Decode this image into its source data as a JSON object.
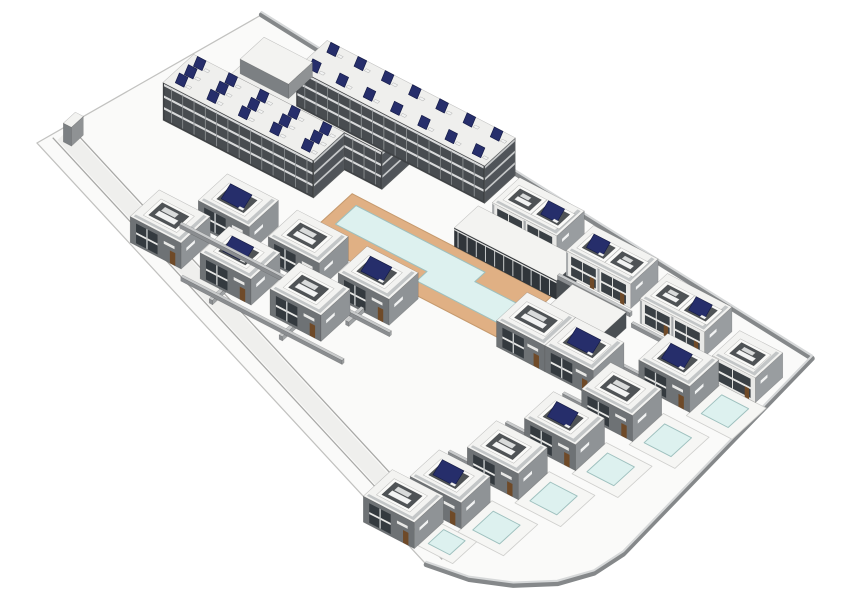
{
  "meta": {
    "view": "axonometric-3d-site-model",
    "subject": "residential-complex-with-apartments-townhouses-villas-and-pools"
  },
  "palette": {
    "bg": "#ffffff",
    "parcel": "#fafaf9",
    "parcelEdge": "#c2c2c0",
    "roadBand": "#efefed",
    "roadEdge": "#a8a8a6",
    "perimWall": "#85888a",
    "perimTop": "#d6d8d9",
    "roof": "#f3f3f1",
    "roofSlab": "#efefed",
    "parapet": "#c3c6c7",
    "faceEdge": "rgba(50,50,50,0.28)",
    "slabWallS": "#3f4245",
    "slabWallE": "#565a5d",
    "slabGlass": "#484c50",
    "slabStripe": "#d9dadb",
    "slabMullion": "#8e9294",
    "villaWallS": "#6e7275",
    "villaWallE": "#8f9396",
    "villaGlass": "#343a3f",
    "villaFloor": "#e8e8e6",
    "villaMullion": "#c7cacb",
    "door": "#6f4a28",
    "thWallS": "#e9e9e7",
    "thWallE": "#999da0",
    "thGlass": "#3a4045",
    "thParty": "#a6a9ab",
    "clubWallE": "#4a4f53",
    "clubGlass": "#30353a",
    "clubMullion": "#cfd1d2",
    "pentWallS": "#7c8083",
    "pentWallE": "#8f9294",
    "wallS": "#8a8d90",
    "wallE": "#9fa2a4",
    "wallTop": "#c9cbcc",
    "panel": "#262e6b",
    "panelEdge": "#141a45",
    "equip": "#f2f3f3",
    "equip2": "#d9dbdb",
    "courtShaft": "#4f5356",
    "courtRim": "#fafaf8",
    "poolWater": "#ddf1ef",
    "poolEdge": "#9ec0be",
    "deckTan": "#e0b084",
    "deckEdge": "#c59a6e",
    "terrace": "#f6f6f4",
    "terraceEdge": "#cfcfcd"
  },
  "projection": {
    "e": [
      2.55,
      1.32
    ],
    "n": [
      1.62,
      -1.48
    ],
    "zs": 2.75,
    "margin": 14
  },
  "scene": {
    "parcel": [
      [
        -30,
        0
      ],
      [
        -10,
        100
      ],
      [
        210,
        76
      ],
      [
        216,
        -44
      ],
      [
        214,
        -58
      ],
      [
        208,
        -70
      ],
      [
        198,
        -80
      ],
      [
        186,
        -87
      ],
      [
        172,
        -90
      ]
    ],
    "perimeterWall": [
      [
        -10,
        100
      ],
      [
        210,
        76
      ],
      [
        216,
        -44
      ],
      [
        214,
        -58
      ],
      [
        208,
        -70
      ],
      [
        198,
        -80
      ],
      [
        186,
        -87
      ],
      [
        172,
        -90
      ]
    ],
    "road": {
      "band": [
        [
          176.1,
          -80.9
        ],
        [
          -25.9,
          9.1
        ]
      ],
      "edges": [
        [
          [
            174.4,
            -84.5
          ],
          [
            -27.6,
            5.5
          ]
        ],
        [
          [
            177.7,
            -77.2
          ],
          [
            -24.3,
            12.8
          ]
        ]
      ]
    },
    "deck": {
      "x": 58,
      "y": 18,
      "w": 74,
      "d": 28
    },
    "mainPool": [
      [
        62,
        30
      ],
      [
        96,
        30
      ],
      [
        96,
        24
      ],
      [
        126,
        24
      ],
      [
        126,
        36
      ],
      [
        110,
        36
      ],
      [
        110,
        42
      ],
      [
        62,
        42
      ]
    ],
    "terraces": [
      {
        "id": "pool-terrace-1",
        "x": 195,
        "y": 26,
        "w": 17,
        "d": 20
      },
      {
        "id": "pool-terrace-2",
        "x": 189,
        "y": 2,
        "w": 17,
        "d": 20
      },
      {
        "id": "pool-terrace-3",
        "x": 183,
        "y": -22,
        "w": 17,
        "d": 20
      },
      {
        "id": "pool-terrace-4",
        "x": 177,
        "y": -46,
        "w": 17,
        "d": 20
      },
      {
        "id": "pool-terrace-5",
        "x": 171,
        "y": -70,
        "w": 17,
        "d": 20
      },
      {
        "id": "pool-terrace-6",
        "x": 165,
        "y": -84,
        "w": 13,
        "d": 14
      }
    ],
    "pools": [
      {
        "id": "villa-pool-1",
        "x": 198,
        "y": 30,
        "w": 10,
        "d": 12
      },
      {
        "id": "villa-pool-2",
        "x": 192,
        "y": 6,
        "w": 10,
        "d": 12
      },
      {
        "id": "villa-pool-3",
        "x": 186,
        "y": -18,
        "w": 10,
        "d": 12
      },
      {
        "id": "villa-pool-4",
        "x": 180,
        "y": -42,
        "w": 10,
        "d": 12
      },
      {
        "id": "villa-pool-5",
        "x": 174,
        "y": -66,
        "w": 10,
        "d": 12
      },
      {
        "id": "villa-pool-6",
        "x": 167,
        "y": -81,
        "w": 8,
        "d": 9
      }
    ],
    "boxes": [
      {
        "id": "apartment-slab-west",
        "type": "slab",
        "x": -6,
        "y": 36,
        "w": 56,
        "d": 18,
        "h": 13,
        "panels": {
          "rows": 3,
          "cols": 5
        }
      },
      {
        "id": "apartment-slab-mid",
        "type": "slab",
        "x": 8,
        "y": 54,
        "w": 56,
        "d": 18,
        "h": 13
      },
      {
        "id": "apartment-penthouse",
        "type": "penthouse",
        "x": 10,
        "y": 56,
        "w": 18,
        "d": 14,
        "h": 18,
        "z0": 13
      },
      {
        "id": "apartment-slab-north",
        "type": "slab",
        "x": 22,
        "y": 70,
        "w": 70,
        "d": 18,
        "h": 13,
        "panels": {
          "rows": 2,
          "cols": 7
        }
      },
      {
        "id": "townhouse-duplex-1",
        "type": "townhouse",
        "x": 100,
        "y": 62,
        "w": 24,
        "d": 16,
        "h": 8.5,
        "courts": [
          {
            "x": 3,
            "y": 4.5,
            "w": 8,
            "d": 7,
            "panel": false
          },
          {
            "x": 13.5,
            "y": 4.5,
            "w": 8,
            "d": 7,
            "panel": true
          }
        ]
      },
      {
        "id": "townhouse-duplex-2",
        "type": "townhouse",
        "x": 130,
        "y": 58,
        "w": 24,
        "d": 16,
        "h": 8.5,
        "courts": [
          {
            "x": 3,
            "y": 4.5,
            "w": 8,
            "d": 7,
            "panel": true
          },
          {
            "x": 13.5,
            "y": 4.5,
            "w": 8,
            "d": 7,
            "panel": false
          }
        ]
      },
      {
        "id": "townhouse-duplex-3",
        "type": "townhouse",
        "x": 160,
        "y": 54,
        "w": 24,
        "d": 16,
        "h": 8.5,
        "courts": [
          {
            "x": 3,
            "y": 4.5,
            "w": 8,
            "d": 7,
            "panel": false
          },
          {
            "x": 13.5,
            "y": 4.5,
            "w": 8,
            "d": 7,
            "panel": true
          }
        ]
      },
      {
        "id": "townhouse-single-1",
        "type": "townhouse",
        "x": 192,
        "y": 46,
        "w": 16,
        "d": 16,
        "h": 8.5,
        "courts": [
          {
            "x": 3.5,
            "y": 4.5,
            "w": 9,
            "d": 7,
            "panel": false
          }
        ]
      },
      {
        "id": "clubhouse",
        "type": "clubhouse",
        "x": 96,
        "y": 46,
        "w": 38,
        "d": 14,
        "h": 6.5
      },
      {
        "id": "pool-house",
        "type": "clubhouse",
        "x": 138,
        "y": 36,
        "w": 20,
        "d": 13,
        "h": 5.5
      },
      {
        "id": "villa-row1-1",
        "type": "villa",
        "x": 30,
        "y": 0,
        "w": 19,
        "d": 17,
        "h": 9,
        "court": {
          "x": 4,
          "y": 4.5,
          "w": 10,
          "d": 8,
          "panel": true
        }
      },
      {
        "id": "villa-row1-2",
        "type": "villa",
        "x": 56,
        "y": 0,
        "w": 19,
        "d": 17,
        "h": 9,
        "court": {
          "x": 4,
          "y": 4.5,
          "w": 10,
          "d": 8,
          "panel": false
        }
      },
      {
        "id": "villa-row1-3",
        "type": "villa",
        "x": 82,
        "y": 0,
        "w": 19,
        "d": 17,
        "h": 9,
        "court": {
          "x": 4,
          "y": 4.5,
          "w": 10,
          "d": 8,
          "panel": true
        }
      },
      {
        "id": "villa-row2-1",
        "type": "villa",
        "x": 18,
        "y": -21,
        "w": 19,
        "d": 17,
        "h": 9,
        "court": {
          "x": 4,
          "y": 4.5,
          "w": 10,
          "d": 8,
          "panel": false
        }
      },
      {
        "id": "villa-row2-2",
        "type": "villa",
        "x": 44,
        "y": -21,
        "w": 19,
        "d": 17,
        "h": 9,
        "court": {
          "x": 4,
          "y": 4.5,
          "w": 10,
          "d": 8,
          "panel": true
        }
      },
      {
        "id": "villa-row2-3",
        "type": "villa",
        "x": 70,
        "y": -21,
        "w": 19,
        "d": 17,
        "h": 9,
        "court": {
          "x": 4,
          "y": 4.5,
          "w": 10,
          "d": 8,
          "panel": false
        }
      },
      {
        "id": "pool-duplex-west",
        "type": "villa",
        "x": 132,
        "y": 14,
        "w": 18,
        "d": 18,
        "h": 9,
        "court": {
          "x": 3.5,
          "y": 5,
          "w": 11,
          "d": 8,
          "panel": false
        }
      },
      {
        "id": "pool-duplex-east",
        "type": "villa",
        "x": 150,
        "y": 14,
        "w": 18,
        "d": 18,
        "h": 9,
        "court": {
          "x": 3.5,
          "y": 5,
          "w": 11,
          "d": 8,
          "panel": true
        }
      },
      {
        "id": "pool-villa-1",
        "type": "villa",
        "x": 176,
        "y": 28,
        "w": 19,
        "d": 17,
        "h": 9,
        "court": {
          "x": 4,
          "y": 4.5,
          "w": 10,
          "d": 8,
          "panel": true
        }
      },
      {
        "id": "pool-villa-2",
        "type": "villa",
        "x": 170,
        "y": 4,
        "w": 19,
        "d": 17,
        "h": 9,
        "court": {
          "x": 4,
          "y": 4.5,
          "w": 10,
          "d": 8,
          "panel": false
        }
      },
      {
        "id": "pool-villa-3",
        "type": "villa",
        "x": 164,
        "y": -20,
        "w": 19,
        "d": 17,
        "h": 9,
        "court": {
          "x": 4,
          "y": 4.5,
          "w": 10,
          "d": 8,
          "panel": true
        }
      },
      {
        "id": "pool-villa-4",
        "type": "villa",
        "x": 158,
        "y": -44,
        "w": 19,
        "d": 17,
        "h": 9,
        "court": {
          "x": 4,
          "y": 4.5,
          "w": 10,
          "d": 8,
          "panel": false
        }
      },
      {
        "id": "pool-villa-5",
        "type": "villa",
        "x": 152,
        "y": -68,
        "w": 19,
        "d": 17,
        "h": 9,
        "court": {
          "x": 4,
          "y": 4.5,
          "w": 10,
          "d": 8,
          "panel": true
        }
      },
      {
        "id": "pool-villa-6",
        "type": "villa",
        "x": 146,
        "y": -86,
        "w": 19,
        "d": 17,
        "h": 9,
        "court": {
          "x": 4,
          "y": 4.5,
          "w": 10,
          "d": 8,
          "panel": false
        }
      },
      {
        "id": "gate-pylon",
        "type": "penthouse",
        "x": -24,
        "y": 6,
        "w": 3,
        "d": 7,
        "h": 6.5
      },
      {
        "id": "garden-wall-row1-front",
        "type": "wall",
        "x": 26,
        "y": -4.6,
        "w": 78,
        "d": 1.2,
        "h": 1.4
      },
      {
        "id": "garden-wall-row2-front",
        "type": "wall",
        "x": 40,
        "y": -26,
        "w": 60,
        "d": 1.2,
        "h": 1.4
      },
      {
        "id": "garden-wall-r1a",
        "type": "wall",
        "x": 38.5,
        "y": -9,
        "w": 1.2,
        "d": 9,
        "h": 1.5
      },
      {
        "id": "garden-wall-r1b",
        "type": "wall",
        "x": 64.5,
        "y": -9,
        "w": 1.2,
        "d": 9,
        "h": 1.5
      },
      {
        "id": "garden-wall-r1c",
        "type": "wall",
        "x": 90.5,
        "y": -9,
        "w": 1.2,
        "d": 9,
        "h": 1.5
      },
      {
        "id": "garden-wall-r2b",
        "type": "wall",
        "x": 52.5,
        "y": -29,
        "w": 1.2,
        "d": 8,
        "h": 1.5
      },
      {
        "id": "garden-wall-r2c",
        "type": "wall",
        "x": 78.5,
        "y": -29,
        "w": 1.2,
        "d": 8,
        "h": 1.5
      },
      {
        "id": "garden-wall-t1",
        "type": "wall",
        "x": 99,
        "y": 58.4,
        "w": 27,
        "d": 1.2,
        "h": 1.4
      },
      {
        "id": "garden-wall-t2",
        "type": "wall",
        "x": 129,
        "y": 54.4,
        "w": 27,
        "d": 1.2,
        "h": 1.4
      },
      {
        "id": "garden-wall-t3",
        "type": "wall",
        "x": 159,
        "y": 50.4,
        "w": 27,
        "d": 1.2,
        "h": 1.4
      },
      {
        "id": "garden-wall-c1",
        "type": "wall",
        "x": 167,
        "y": 31,
        "w": 9,
        "d": 1.2,
        "h": 1.5
      },
      {
        "id": "garden-wall-c2",
        "type": "wall",
        "x": 161,
        "y": 7,
        "w": 9,
        "d": 1.2,
        "h": 1.5
      },
      {
        "id": "garden-wall-c3",
        "type": "wall",
        "x": 155,
        "y": -17,
        "w": 9,
        "d": 1.2,
        "h": 1.5
      },
      {
        "id": "garden-wall-c4",
        "type": "wall",
        "x": 149,
        "y": -41,
        "w": 9,
        "d": 1.2,
        "h": 1.5
      },
      {
        "id": "garden-wall-c5",
        "type": "wall",
        "x": 143,
        "y": -65,
        "w": 9,
        "d": 1.2,
        "h": 1.5
      }
    ]
  }
}
